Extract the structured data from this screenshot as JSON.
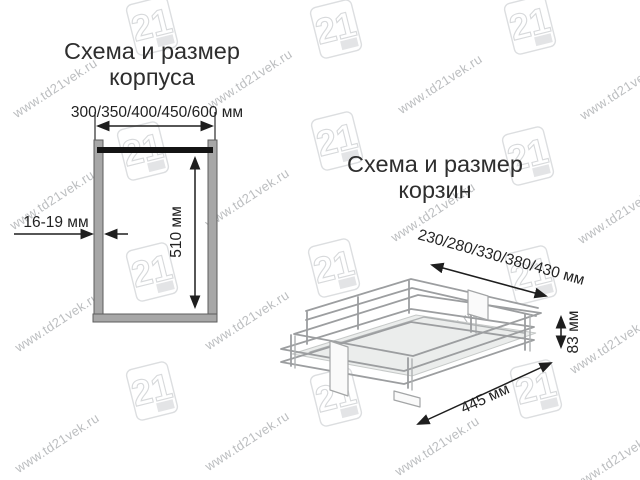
{
  "page": {
    "background": "#ffffff"
  },
  "watermark": {
    "text": "www.td21vek.ru",
    "logo_text": "21",
    "text_color": "#bcbec0",
    "logo_color": "#dcdee0",
    "text_positions": [
      [
        55,
        88
      ],
      [
        250,
        79
      ],
      [
        440,
        84
      ],
      [
        622,
        90
      ],
      [
        52,
        200
      ],
      [
        247,
        198
      ],
      [
        433,
        212
      ],
      [
        620,
        214
      ],
      [
        57,
        322
      ],
      [
        247,
        320
      ],
      [
        433,
        339
      ],
      [
        612,
        344
      ],
      [
        57,
        443
      ],
      [
        247,
        441
      ],
      [
        437,
        446
      ],
      [
        616,
        459
      ]
    ],
    "logo_positions": [
      [
        152,
        26
      ],
      [
        336,
        29
      ],
      [
        530,
        25
      ],
      [
        143,
        151
      ],
      [
        337,
        141
      ],
      [
        528,
        156
      ],
      [
        152,
        272
      ],
      [
        334,
        268
      ],
      [
        531,
        275
      ],
      [
        152,
        391
      ],
      [
        336,
        397
      ],
      [
        536,
        389
      ]
    ]
  },
  "cabinet_diagram": {
    "title_line1": "Схема и размер",
    "title_line2": "корпуса",
    "width_label": "300/350/400/450/600 мм",
    "height_label": "510 мм",
    "panel_thickness_label": "16-19 мм",
    "wall_fill": "#a7a7a7",
    "wall_stroke": "#5e5e5e",
    "top_bar_color": "#141414"
  },
  "basket_diagram": {
    "title_line1": "Схема и размер",
    "title_line2": "корзин",
    "depth_label": "230/280/330/380/430 мм",
    "height_label": "83 мм",
    "length_label": "445 мм",
    "wire_color": "#9c9ea0",
    "floor_fill": "#ebedec"
  }
}
